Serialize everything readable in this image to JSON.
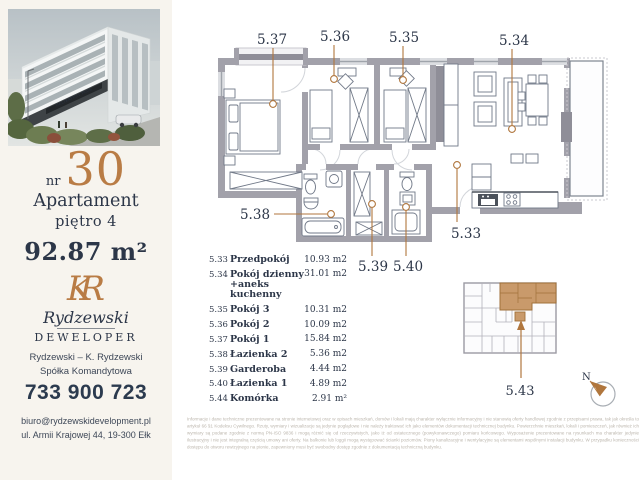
{
  "sidebar": {
    "photo_sign": "DELIKATESY PLUS",
    "unit_prefix": "nr",
    "unit_number": "30",
    "unit_type": "Apartament",
    "floor": "piętro 4",
    "area": "92.87 m²",
    "logo_monogram": "KR",
    "logo_name": "Rydzewski",
    "logo_sub": "DEWELOPER",
    "company_line1": "Rydzewski – K. Rydzewski",
    "company_line2": "Spółka Komandytowa",
    "phone": "733 900 723",
    "email": "biuro@rydzewskidevelopment.pl",
    "address": "ul. Armii Krajowej 44, 19-300 Ełk"
  },
  "plan": {
    "labels": {
      "l533": "5.33",
      "l534": "5.34",
      "l535": "5.35",
      "l536": "5.36",
      "l537": "5.37",
      "l538": "5.38",
      "l539": "5.39",
      "l540": "5.40",
      "l543": "5.43"
    },
    "compass_n": "N"
  },
  "rooms": [
    {
      "no": "5.33",
      "name": "Przedpokój",
      "area": "10.93 m2"
    },
    {
      "no": "5.34",
      "name": "Pokój dzienny",
      "name2": "+aneks kuchenny",
      "area": "31.01 m2"
    },
    {
      "no": "5.35",
      "name": "Pokój 3",
      "area": "10.31 m2"
    },
    {
      "no": "5.36",
      "name": "Pokój 2",
      "area": "10.09 m2"
    },
    {
      "no": "5.37",
      "name": "Pokój 1",
      "area": "15.84 m2"
    },
    {
      "no": "5.38",
      "name": "Łazienka 2",
      "area": "5.36 m2"
    },
    {
      "no": "5.39",
      "name": "Garderoba",
      "area": "4.44 m2"
    },
    {
      "no": "5.40",
      "name": "Łazienka 1",
      "area": "4.89 m2"
    },
    {
      "no": "5.44",
      "name": "Komórka",
      "area": "2.91 m²"
    }
  ],
  "colors": {
    "accent_copper": "#b97c45",
    "navy_text": "#2c3648",
    "wall_gray": "#a2a1aa",
    "sidebar_cream": "#f7f4ee",
    "highlight_tan": "#c99a6b"
  },
  "disclaimer": "Informacje i dane techniczne prezentowane na stronie internetowej oraz w opisach mieszkań, domów i lokali mają charakter wyłącznie informacyjny i nie stanowią oferty handlowej zgodnie z przepisami prawa, tak jak określa to artykuł 66 §1 Kodeksu Cywilnego. Rzuty, wymiary i wizualizacje są jedynie poglądowe i nie należy traktować ich jako elementów dokumentacji technicznej budynku. Powierzchnie mieszkań, lokali i pomieszczeń, jak również ich wymiary są podane zgodnie z normą PN-ISO 9836 i mogą różnić się od rzeczywistych, jako iż od ostatecznego (powykonawczego) pomiaru końcowego. Wyposażenie prezentowane na rysunkach ma charakter jedynie ilustracyjny i nie jest integralną częścią umowy ani oferty. Na balkonie lub loggii mogą występować ścianki poziomów. Piony kanalizacyjne i wentylacyjne są elementami wspólnymi instalacji budynku. W przypadku konieczności dostępu do otworu rewizyjnego na pionie, zapewniony musi być swobodny dostęp zgodnie z dokumentacją techniczną budynku."
}
